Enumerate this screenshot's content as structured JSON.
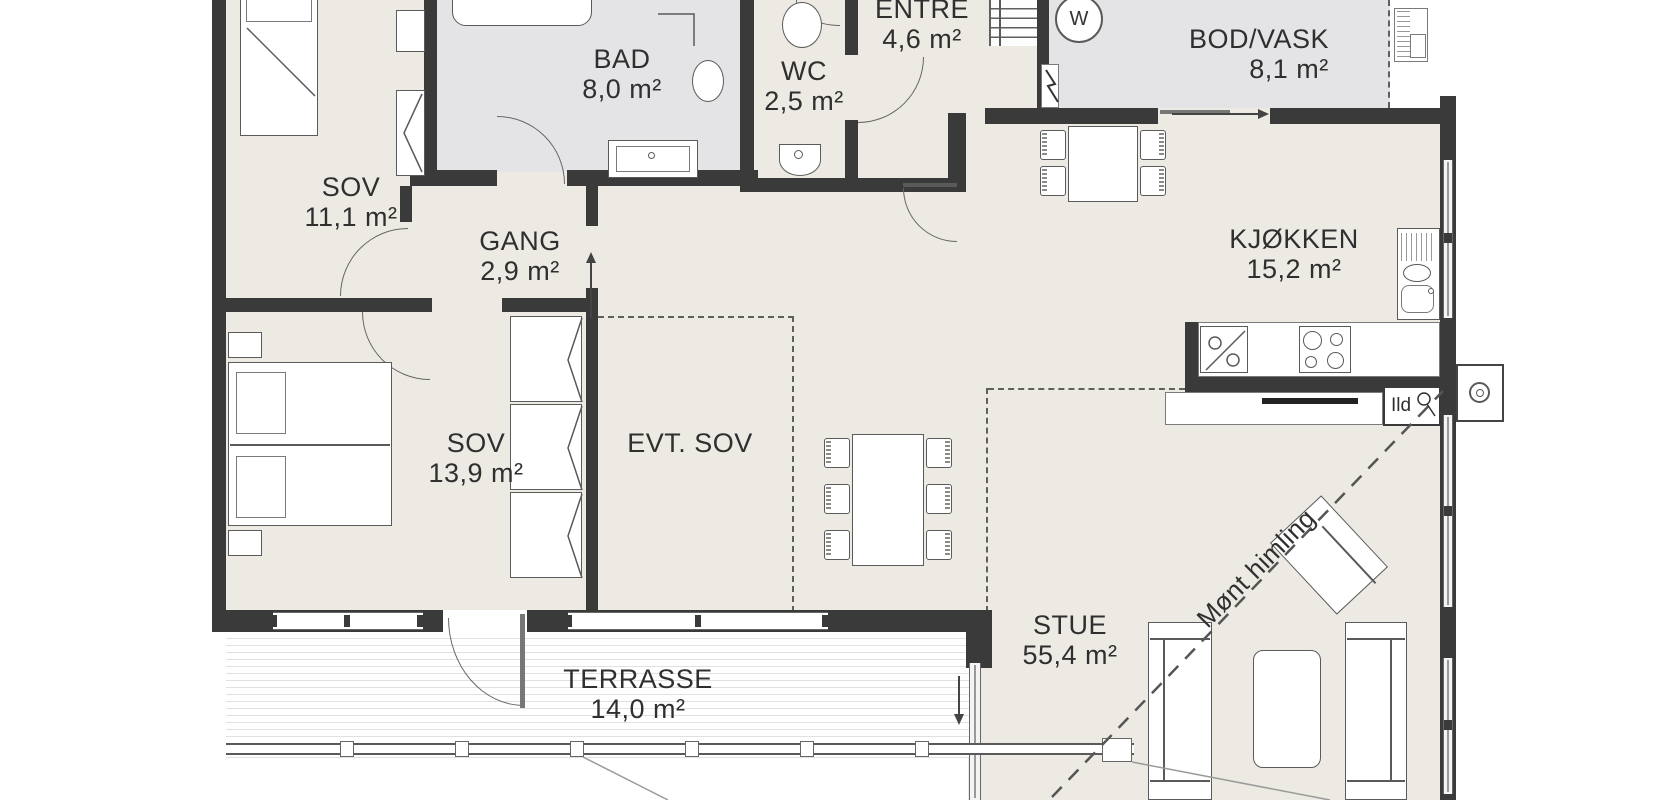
{
  "rooms": {
    "sov1": {
      "name": "SOV",
      "area": "11,1 m²"
    },
    "bad": {
      "name": "BAD",
      "area": "8,0 m²"
    },
    "wc": {
      "name": "WC",
      "area": "2,5 m²"
    },
    "entre": {
      "name": "ENTRE",
      "area": "4,6 m²"
    },
    "bod_vask": {
      "name": "BOD/VASK",
      "area": "8,1 m²"
    },
    "kjokken": {
      "name": "KJØKKEN",
      "area": "15,2 m²"
    },
    "gang": {
      "name": "GANG",
      "area": "2,9 m²"
    },
    "sov2": {
      "name": "SOV",
      "area": "13,9 m²"
    },
    "evt_sov": {
      "name": "EVT. SOV"
    },
    "stue": {
      "name": "STUE",
      "area": "55,4 m²"
    },
    "terrasse": {
      "name": "TERRASSE",
      "area": "14,0 m²"
    }
  },
  "annotations": {
    "ridge_line": "Mønt himling",
    "fireplace": "Ild",
    "washing_machine": "W"
  },
  "colors": {
    "wall": "#3a3a3a",
    "floor": "#edeae4",
    "wet_floor": "#e4e4e6",
    "outline": "#5a5a5a",
    "text": "#2f2f2f"
  }
}
